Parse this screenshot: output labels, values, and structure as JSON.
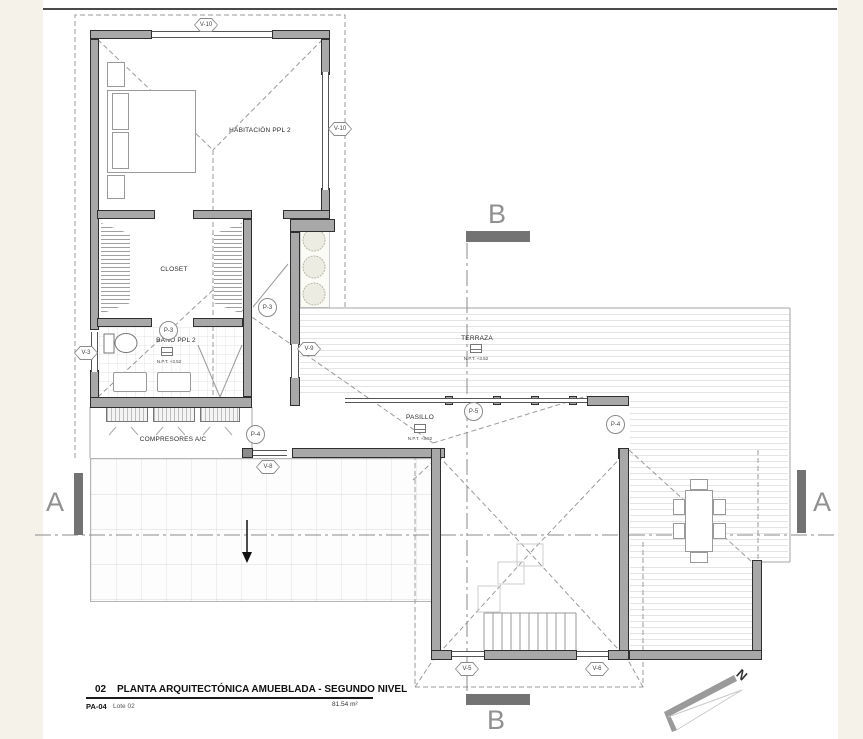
{
  "title_block": {
    "number": "02",
    "title": "PLANTA ARQUITECTÓNICA AMUEBLADA - SEGUNDO NIVEL",
    "sheet": "PA-04",
    "lot": "Lote 02",
    "area": "81.54 m²"
  },
  "rooms": {
    "habitacion": {
      "label": "HABITACIÓN PPL 2"
    },
    "closet": {
      "label": "CLOSET"
    },
    "bano": {
      "label": "BAÑO PPL 2",
      "level": "N.P.T. +3.52"
    },
    "compresores": {
      "label": "COMPRESORES A/C"
    },
    "terraza": {
      "label": "TERRAZA",
      "level": "N.P.T. +3.52"
    },
    "pasillo": {
      "label": "PASILLO",
      "level": "N.P.T. +3.52"
    }
  },
  "callouts": {
    "v10_top": "V-10",
    "v10_right": "V-10",
    "v3": "V-3",
    "v9": "V-9",
    "v8": "V-8",
    "v5": "V-5",
    "v6": "V-6",
    "p3_hall": "P-3",
    "p3_bath": "P-3",
    "p4_left": "P-4",
    "p4_right": "P-4",
    "p5": "P-5"
  },
  "sections": {
    "a": "A",
    "b": "B"
  },
  "north": {
    "letter": "N"
  },
  "colors": {
    "wall": "#a8a8a8",
    "wall_dark": "#8c8c8c",
    "section_bar": "#737373",
    "dash_line": "#9a9a9a",
    "margin": "#f5f2ea"
  }
}
